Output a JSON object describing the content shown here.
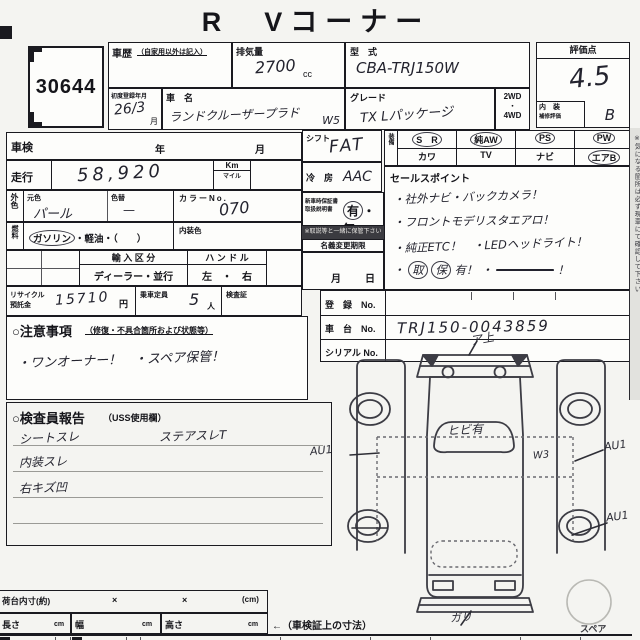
{
  "page": {
    "title": "R　Vコーナー"
  },
  "lot": {
    "number": "30644"
  },
  "top": {
    "history_label": "車歴",
    "history_sub": "（自家用以外は記入）",
    "disp_label": "排気量",
    "disp_value": "2700",
    "disp_unit": "cc",
    "model_label": "型　式",
    "model_value": "CBA-TRJ150W",
    "firstreg_label": "初度登録年月",
    "firstreg_value": "26/3",
    "firstreg_unit": "月",
    "name_label": "車　名",
    "name_value": "ランドクルーザープラド",
    "name_note": "W5",
    "grade_label": "グレード",
    "grade_value": "TX Lパッケージ",
    "drive_top": "2WD",
    "drive_dot": "・",
    "drive_bottom": "4WD",
    "score_label": "評価点",
    "score_value": "4.5",
    "interior_label": "内　装",
    "interior_sub": "補修評価",
    "interior_value": "B"
  },
  "left": {
    "shaken_label": "車検",
    "year_label": "年",
    "month_label": "月",
    "mileage_label": "走行",
    "mileage_value": "58,920",
    "km_label": "Km",
    "mile_label": "マイル",
    "extcolor_label": "外色",
    "basecolor_label": "元色",
    "basecolor_value": "パール",
    "recolor_label": "色替",
    "recolor_value": "—",
    "colorno_label": "カラーNo.",
    "colorno_value": "070",
    "fuel_label": "燃料",
    "fuel_gasoline": "ガソリン",
    "fuel_rest": "・軽油・（　　）",
    "intcolor_label": "内装色",
    "import_label": "輸 入 区 分",
    "import_value": "ディーラー・並行",
    "handle_label": "ハ ン ド ル",
    "handle_value": "左　・　右",
    "recycle_label1": "リサイクル",
    "recycle_label2": "預託金",
    "recycle_value": "15710",
    "recycle_unit": "円",
    "capacity_label": "乗車定員",
    "capacity_value": "5",
    "capacity_unit": "人",
    "doc_label": "検査証"
  },
  "caution": {
    "title": "○注意事項",
    "sub": "（修復・不具合箇所および状態等）",
    "line": "・ワンオーナー！　・スペア保管！"
  },
  "middle": {
    "shift_label": "シフト",
    "shift_value": "FAT",
    "ac_label": "冷　房",
    "ac_value": "AAC",
    "equip_label": "装備",
    "equip": [
      {
        "label": "S　R",
        "circled": true
      },
      {
        "label": "純AW",
        "circled": true
      },
      {
        "label": "PS",
        "circled": true
      },
      {
        "label": "PW",
        "circled": true
      },
      {
        "label": "カワ",
        "circled": false
      },
      {
        "label": "TV",
        "circled": false
      },
      {
        "label": "ナビ",
        "circled": false
      },
      {
        "label": "エアB",
        "circled": true
      }
    ],
    "warranty_label1": "新車時保証書",
    "warranty_label2": "取扱説明書",
    "warranty_yes": "有",
    "warranty_dot": "・",
    "warranty_no": "無",
    "warranty_note": "※取説等と一緒に保管下さい",
    "transfer_label": "名義変更期限",
    "month_label": "月",
    "day_label": "日",
    "sales_label": "セールスポイント",
    "sales_lines": [
      "・社外ナビ・バックカメラ！",
      "・フロントモデリスタエアロ！",
      "・純正ETC！　・LEDヘッドライト！"
    ],
    "sales_bullet": "・",
    "sales_mark1": "取",
    "sales_mark2": "保",
    "sales_tail": "有！",
    "sales_struck": "―――――",
    "sales_bang": "！"
  },
  "registration": {
    "reg_label": "登　録　No.",
    "reg_value": "",
    "chassis_label": "車　台　No.",
    "chassis_value": "TRJ150-0043859",
    "serial_label": "シリアル No.",
    "serial_value": ""
  },
  "inspector": {
    "title": "○検査員報告",
    "sub": "（USS使用欄）",
    "line1a": "シートスレ",
    "line1b": "ステアスレT",
    "line2": "内装スレ",
    "line3": "右キズ凹"
  },
  "diagram": {
    "top_note": "ア上",
    "windshield_note": "ヒビ有",
    "left_note": "AU1",
    "right_note1": "AU1",
    "right_note2": "AU1",
    "inner_note": "W3",
    "bottom_note": "ガリ",
    "spare_label": "スペア"
  },
  "dimensions": {
    "cargo_label": "荷台内寸(約)",
    "times1": "×",
    "times2": "×",
    "unit": "(cm)",
    "length_label": "長さ",
    "width_label": "幅",
    "height_label": "高さ",
    "cell_unit": "cm",
    "ref_note": "←（車検証上の寸法）"
  },
  "side_note": "※気になる箇所は必ず現車にて確認して下さい"
}
